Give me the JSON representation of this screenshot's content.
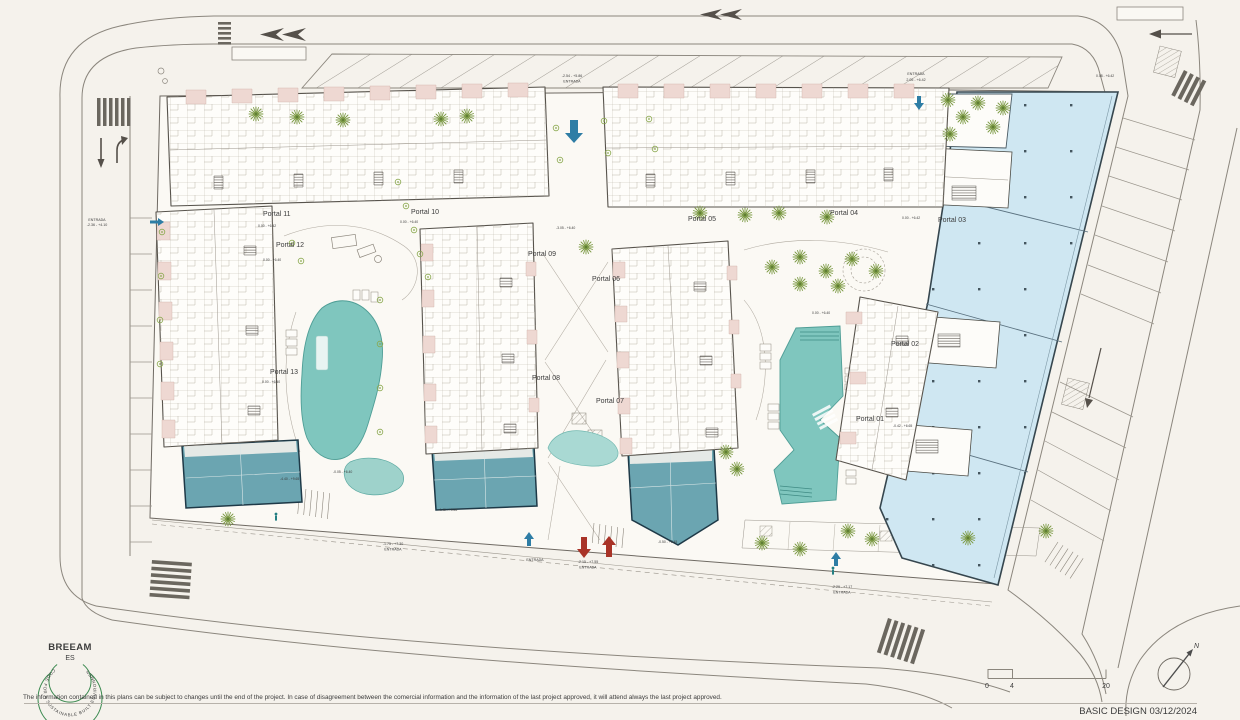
{
  "portals": [
    {
      "label": "Portal 01"
    },
    {
      "label": "Portal 02"
    },
    {
      "label": "Portal 03"
    },
    {
      "label": "Portal 04"
    },
    {
      "label": "Portal 05"
    },
    {
      "label": "Portal 06"
    },
    {
      "label": "Portal 07"
    },
    {
      "label": "Portal 08"
    },
    {
      "label": "Portal 09"
    },
    {
      "label": "Portal 10"
    },
    {
      "label": "Portal 11"
    },
    {
      "label": "Portal 12"
    },
    {
      "label": "Portal 13"
    }
  ],
  "entrances": [
    {
      "id": "top-center",
      "elevation": "-2.54 - +5.86",
      "label": "ENTRADA"
    },
    {
      "id": "top-right",
      "elevation": "2.05 - +6.42",
      "label": "ENTRADA"
    },
    {
      "id": "west",
      "elevation": "-2.36 - +4.10",
      "label": "ENTRADA"
    },
    {
      "id": "south-west",
      "elevation": "-1.75 - +7.30",
      "label": "ENTRADA"
    },
    {
      "id": "south-center",
      "elevation": "-2.15 - +7.55",
      "label": "ENTRADA"
    },
    {
      "id": "south-east",
      "elevation": "-2.29 - +7.17",
      "label": "ENTRADA"
    },
    {
      "id": "south-small",
      "elevation": "",
      "label": "ENTRADA"
    }
  ],
  "levels": [
    "0.00 - +6.42",
    "0.00 - +6.40",
    "-3.05 - +6.40",
    "0.00 - +6.42",
    "0.00 - +6.40",
    "-4.40 - +9.65",
    "-0.05 - +6.40",
    "-4.40 - +9.65",
    "-0.50 - +5.45",
    "0.00 - +6.40",
    "0.08 - +6.42",
    "-0.42 - +6.65",
    "0.00 - +6.40"
  ],
  "footer": {
    "disclaimer": "The information contained in this plans can be subject to changes until the end of the project. In case of disagreement between the comercial information and the information of the last project approved, it will attend always the last project approved.",
    "stamp": "BASIC DESIGN 03/12/2024"
  },
  "logo": {
    "name": "BREEAM",
    "region": "ES",
    "ring": "CODE FOR A SUSTAINABLE BUILT ENVIRONMENT"
  },
  "scale_bar": {
    "tick_0": "0",
    "tick_4": "4",
    "tick_20": "20"
  },
  "compass": {
    "north": "N"
  },
  "colors": {
    "paper": "#f5f2ec",
    "pool": "#7fc6be",
    "pool_light": "#9ed2cb",
    "pond": "#a9d9d3",
    "community": "#6ba5b1",
    "commercial": "#cfe7f2",
    "terrace_pink": "#eed8d2",
    "landscape_green": "#7c9a45",
    "breeam_green": "#3b8a50",
    "entry_blue": "#2e7da5",
    "ramp_red": "#a93327"
  }
}
